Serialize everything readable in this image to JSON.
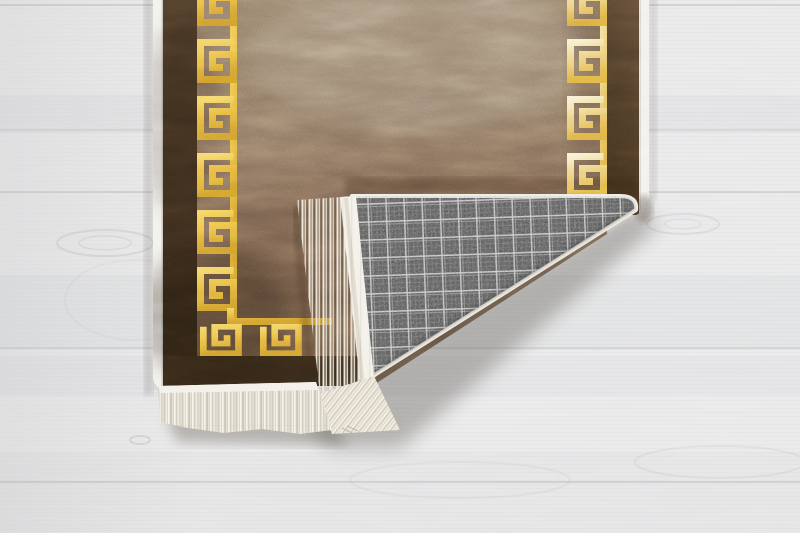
{
  "meta": {
    "type": "product-photograph",
    "subject": "rug-with-folded-corner",
    "description": "Overhead photo of a brown suede-look runner rug with a gold Greek-key meander border. The bottom-right corner is folded over, revealing a gray tartan-check woven backing and a cream fringe. The rug lies on whitewashed wood planks.",
    "image_width": 800,
    "image_height": 533
  },
  "colors": {
    "floor_base": "#eaeaeb",
    "floor_grain": "#d8d8da",
    "floor_seam": "#c9c9cb",
    "binding": "#f2f0ea",
    "field_top": "#927c66",
    "field_mid": "#8b7460",
    "field_bottom": "#66503c",
    "border_left_top": "#4c3b29",
    "border_left_bottom": "#2a1f13",
    "border_right_top": "#5e4a36",
    "border_right_bottom": "#3e2e1d",
    "border_bottom": "#342718",
    "gold_light": "#f4d260",
    "gold_mid": "#eaba41",
    "gold_deep": "#cd982b",
    "gold_pale": "#f7efcf",
    "fringe_cream": "#e9e4d8",
    "fringe_header": "#f3f1ea",
    "fringe_shade": "#cec6b4",
    "plaid_base": "#535353",
    "plaid_line_bright": "#d8d8d8",
    "plaid_line_dim": "#8f8f8f",
    "shadow": "#6f6a62"
  },
  "rug": {
    "border_motif": "greek-key-meander",
    "motif_columns": 2,
    "left_column_motifs_visible": 6,
    "right_column_motifs_visible": 4,
    "corner_motifs_visible": 2,
    "fringe": "cream tassel fringe on bottom edge and folded flap edge",
    "backing_pattern": "gray tartan check",
    "fold": "bottom-right corner folded over toward upper-left"
  },
  "floor": {
    "material": "whitewashed wood planks, horizontal grain",
    "plank_seams_y": [
      5,
      130,
      192,
      348,
      482
    ],
    "knots": [
      [
        105,
        243
      ],
      [
        683,
        224
      ],
      [
        140,
        440
      ]
    ]
  }
}
